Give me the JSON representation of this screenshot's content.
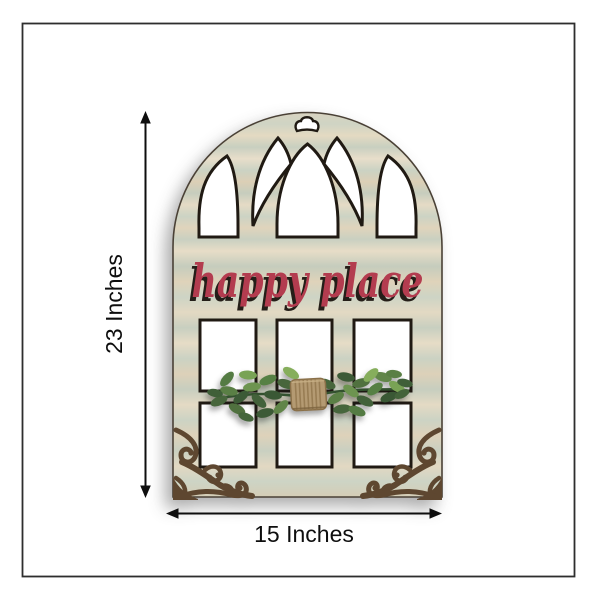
{
  "annotation": {
    "height_label": "23 Inches",
    "width_label": "15 Inches"
  },
  "product": {
    "sign_text": "happy place",
    "colors": {
      "sign_text": "#b33c4f",
      "sign_shadow": "#241e18",
      "wood_sage": "#c9d1c2",
      "wood_cream": "#e7ddc5",
      "wood_tan": "#dbc9ae",
      "cutout_edge": "#201a13",
      "metal_scroll": "#5e4730",
      "leaf_green_dark": "#3c5a36",
      "leaf_green_light": "#86ae5c",
      "twine": "#b49a72",
      "frame_border": "#2e2e2e",
      "dimension_ink": "#0e0e0e"
    }
  }
}
